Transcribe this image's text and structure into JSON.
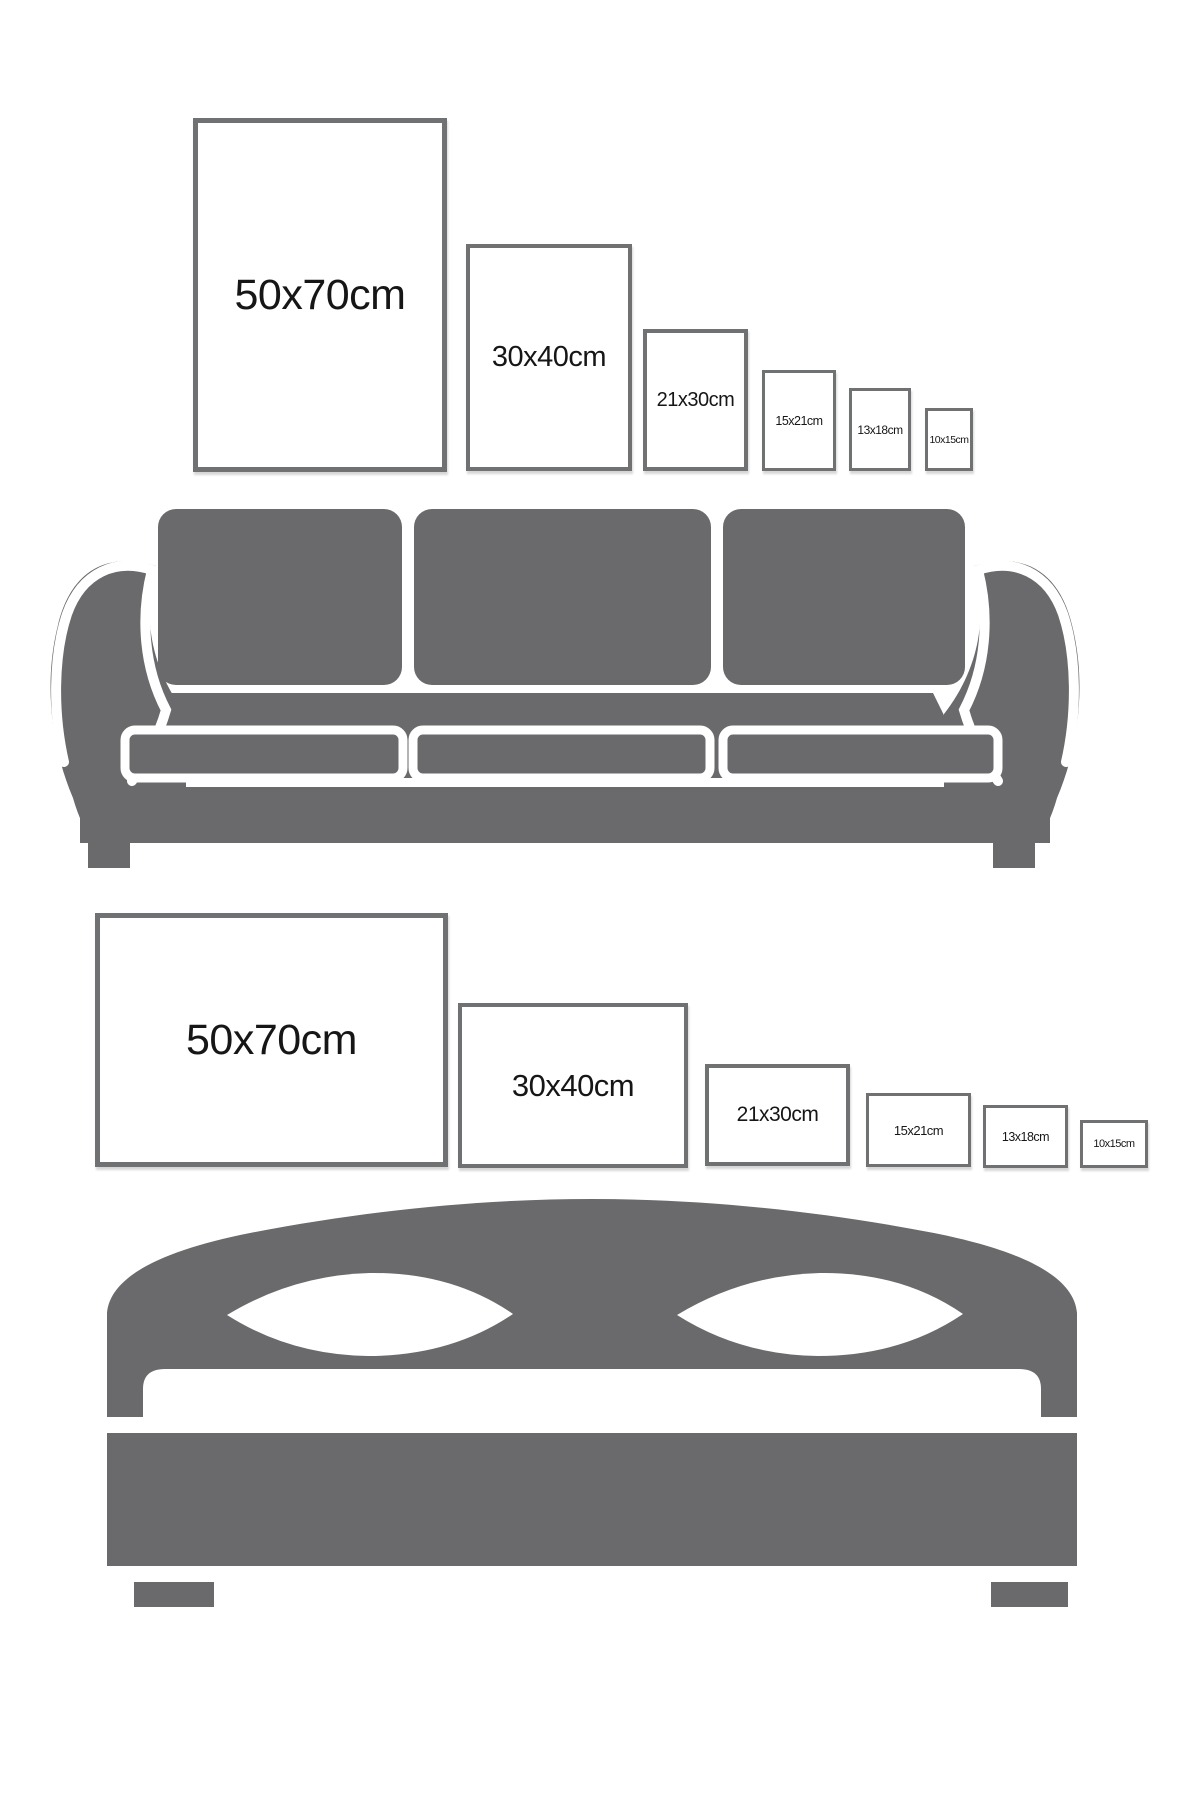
{
  "colors": {
    "background": "#ffffff",
    "furniture_gray": "#6a6a6c",
    "frame_border": "#707173",
    "label_text": "#161616"
  },
  "sofa_section": {
    "furniture_icon": "sofa-silhouette",
    "sizes": [
      {
        "label": "50x70cm"
      },
      {
        "label": "30x40cm"
      },
      {
        "label": "21x30cm"
      },
      {
        "label": "15x21cm"
      },
      {
        "label": "13x18cm"
      },
      {
        "label": "10x15cm"
      }
    ]
  },
  "bed_section": {
    "furniture_icon": "bed-silhouette",
    "sizes": [
      {
        "label": "50x70cm"
      },
      {
        "label": "30x40cm"
      },
      {
        "label": "21x30cm"
      },
      {
        "label": "15x21cm"
      },
      {
        "label": "13x18cm"
      },
      {
        "label": "10x15cm"
      }
    ]
  }
}
